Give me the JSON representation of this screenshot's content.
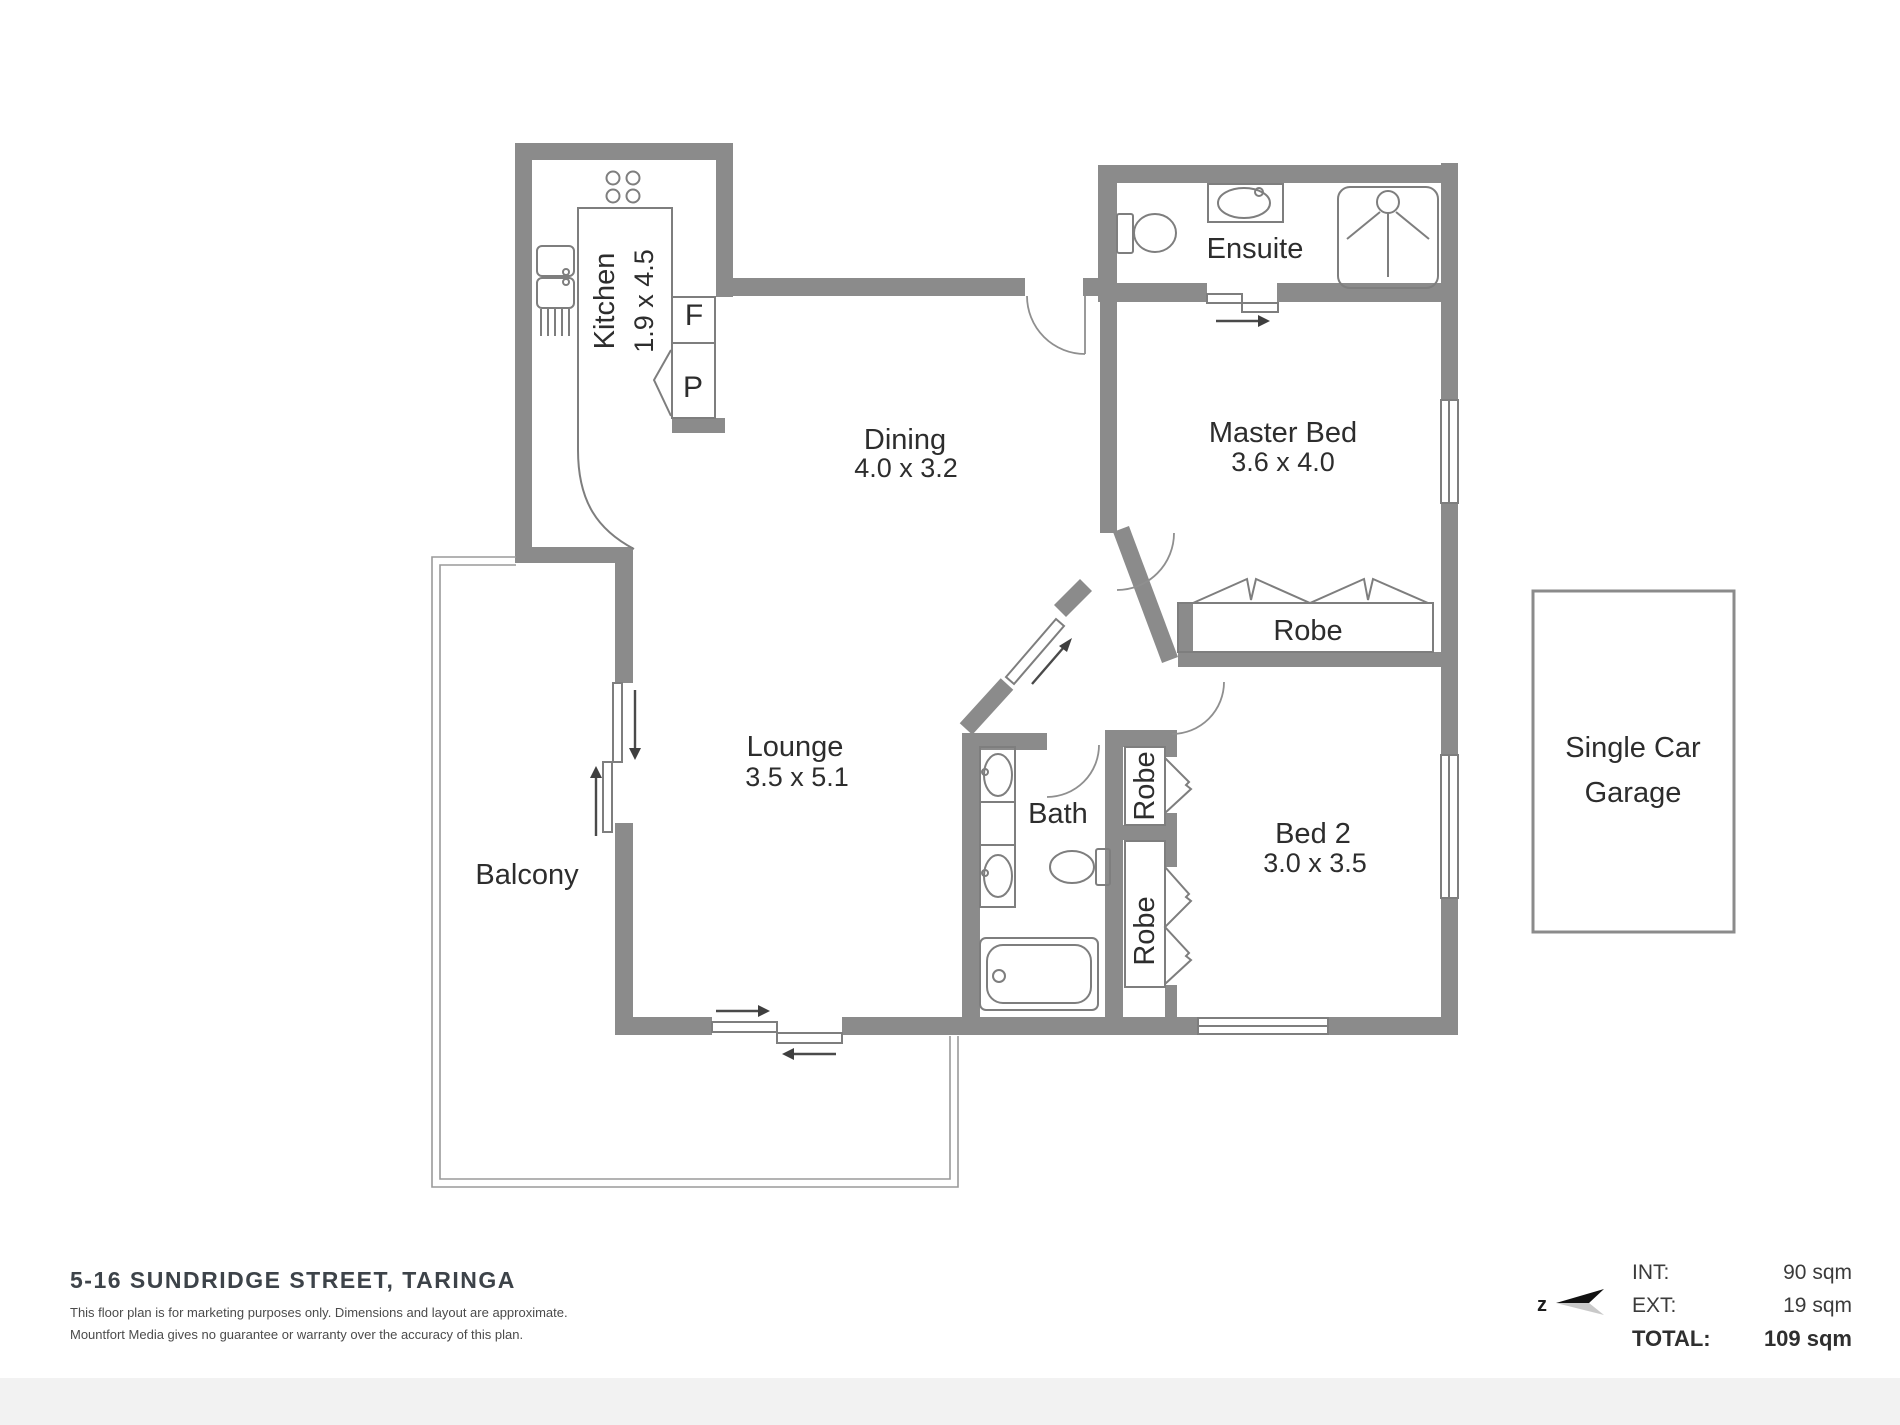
{
  "plan": {
    "rooms": {
      "kitchen": {
        "name": "Kitchen",
        "dims": "1.9 x 4.5"
      },
      "dining": {
        "name": "Dining",
        "dims": "4.0 x 3.2"
      },
      "ensuite": {
        "name": "Ensuite"
      },
      "master_bed": {
        "name": "Master Bed",
        "dims": "3.6 x 4.0"
      },
      "master_robe": {
        "name": "Robe"
      },
      "lounge": {
        "name": "Lounge",
        "dims": "3.5 x 5.1"
      },
      "balcony": {
        "name": "Balcony"
      },
      "bath": {
        "name": "Bath"
      },
      "robe_1": {
        "name": "Robe"
      },
      "robe_2": {
        "name": "Robe"
      },
      "bed_2": {
        "name": "Bed 2",
        "dims": "3.0 x 3.5"
      },
      "garage": {
        "name_line1": "Single Car",
        "name_line2": "Garage"
      }
    },
    "appliances": {
      "fridge": "F",
      "pantry": "P"
    }
  },
  "footer": {
    "address": "5-16 SUNDRIDGE STREET, TARINGA",
    "disclaimer_line1": "This floor plan is for marketing purposes only. Dimensions and layout are approximate.",
    "disclaimer_line2": "Mountfort Media gives no guarantee or warranty over the accuracy of this plan.",
    "north_label": "z",
    "areas": {
      "int_label": "INT:",
      "int_value": "90 sqm",
      "ext_label": "EXT:",
      "ext_value": "19 sqm",
      "total_label": "TOTAL:",
      "total_value": "109 sqm"
    }
  },
  "colors": {
    "wall": "#8b8b8b",
    "fixture_line": "#7e7e7e",
    "room_text": "#2d2d2d",
    "footer_text": "#3d4349",
    "bottom_band": "#f2f2f2"
  }
}
